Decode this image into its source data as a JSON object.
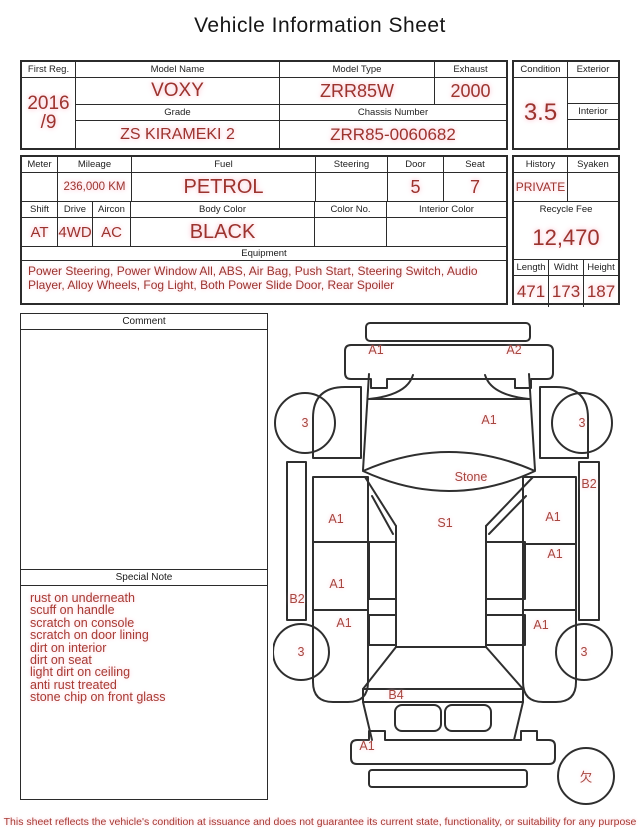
{
  "title": "Vehicle Information Sheet",
  "top_table": {
    "first_reg": {
      "label": "First Reg.",
      "value": "2016\n/9"
    },
    "model_name": {
      "label": "Model Name",
      "value": "VOXY"
    },
    "model_type": {
      "label": "Model Type",
      "value": "ZRR85W"
    },
    "exhaust": {
      "label": "Exhaust",
      "value": "2000"
    },
    "grade": {
      "label": "Grade",
      "value": "ZS KIRAMEKI 2"
    },
    "chassis_number": {
      "label": "Chassis Number",
      "value": "ZRR85-0060682"
    },
    "condition": {
      "label": "Condition",
      "value": "3.5"
    },
    "exterior": {
      "label": "Exterior",
      "value": ""
    },
    "interior": {
      "label": "Interior",
      "value": ""
    }
  },
  "spec_table": {
    "meter": {
      "label": "Meter",
      "value": ""
    },
    "mileage": {
      "label": "Mileage",
      "value": "236,000 KM"
    },
    "fuel": {
      "label": "Fuel",
      "value": "PETROL"
    },
    "steering": {
      "label": "Steering",
      "value": ""
    },
    "door": {
      "label": "Door",
      "value": "5"
    },
    "seat": {
      "label": "Seat",
      "value": "7"
    },
    "shift": {
      "label": "Shift",
      "value": "AT"
    },
    "drive": {
      "label": "Drive",
      "value": "4WD"
    },
    "aircon": {
      "label": "Aircon",
      "value": "AC"
    },
    "body_color": {
      "label": "Body Color",
      "value": "BLACK"
    },
    "color_no": {
      "label": "Color No.",
      "value": ""
    },
    "interior_color": {
      "label": "Interior Color",
      "value": ""
    },
    "equipment": {
      "label": "Equipment",
      "value": "Power Steering, Power Window All, ABS, Air Bag, Push Start, Steering Switch, Audio Player, Alloy Wheels, Fog Light, Both Power Slide Door, Rear Spoiler"
    },
    "history": {
      "label": "History",
      "value": "PRIVATE"
    },
    "syaken": {
      "label": "Syaken",
      "value": ""
    },
    "recycle_fee": {
      "label": "Recycle Fee",
      "value": "12,470"
    },
    "length": {
      "label": "Length",
      "value": "471"
    },
    "width": {
      "label": "Widht",
      "value": "173"
    },
    "height": {
      "label": "Height",
      "value": "187"
    }
  },
  "comment": {
    "label": "Comment",
    "value": ""
  },
  "special_note": {
    "label": "Special Note",
    "lines": [
      "rust on underneath",
      "scuff on handle",
      "scratch on console",
      "scratch on door lining",
      "dirt on interior",
      "dirt on seat",
      "light dirt on ceiling",
      "anti rust treated",
      "stone chip on front glass"
    ]
  },
  "diagram": {
    "labels": [
      {
        "name": "front-bumper-left",
        "text": "A1",
        "x": 103,
        "y": 38
      },
      {
        "name": "front-bumper-right",
        "text": "A2",
        "x": 241,
        "y": 38
      },
      {
        "name": "front-left-wheel",
        "text": "3",
        "x": 32,
        "y": 111
      },
      {
        "name": "front-right-wheel",
        "text": "3",
        "x": 309,
        "y": 111
      },
      {
        "name": "cowl-right",
        "text": "A1",
        "x": 216,
        "y": 108
      },
      {
        "name": "windshield",
        "text": "Stone",
        "x": 198,
        "y": 165
      },
      {
        "name": "right-sill",
        "text": "B2",
        "x": 316,
        "y": 172
      },
      {
        "name": "roof",
        "text": "S1",
        "x": 172,
        "y": 211
      },
      {
        "name": "left-front-door",
        "text": "A1",
        "x": 63,
        "y": 207
      },
      {
        "name": "right-front-door",
        "text": "A1",
        "x": 280,
        "y": 205
      },
      {
        "name": "right-slide-door",
        "text": "A1",
        "x": 282,
        "y": 242
      },
      {
        "name": "left-slide-door",
        "text": "A1",
        "x": 64,
        "y": 272
      },
      {
        "name": "left-sill",
        "text": "B2",
        "x": 24,
        "y": 287
      },
      {
        "name": "left-quarter-panel",
        "text": "A1",
        "x": 71,
        "y": 311
      },
      {
        "name": "right-quarter-panel",
        "text": "A1",
        "x": 268,
        "y": 313
      },
      {
        "name": "rear-left-wheel",
        "text": "3",
        "x": 28,
        "y": 340
      },
      {
        "name": "rear-right-wheel",
        "text": "3",
        "x": 311,
        "y": 340
      },
      {
        "name": "rear-window",
        "text": "B4",
        "x": 123,
        "y": 383
      },
      {
        "name": "rear-bumper-left",
        "text": "A1",
        "x": 94,
        "y": 434
      },
      {
        "name": "spare-missing",
        "text": "欠",
        "x": 313,
        "y": 464
      }
    ]
  },
  "footer": {
    "disclaimer": "This sheet reflects the vehicle's condition at issuance and does not guarantee its current state, functionality, or suitability for any purpose"
  },
  "colors": {
    "value_red": "#9c332e",
    "note_red": "#a83a33",
    "diagram_label_red": "#a8463f",
    "line_dark": "#2b2b2b"
  }
}
